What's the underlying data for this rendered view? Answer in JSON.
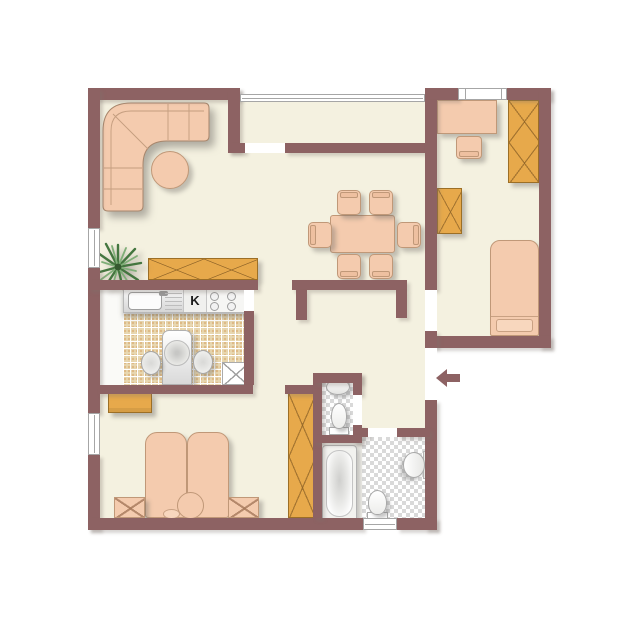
{
  "floorplan": {
    "title": "apartment-floor-plan",
    "kitchen_label": "K",
    "entrance": {
      "symbol": "arrow-left",
      "location": "right-wall-vestibule"
    },
    "colors": {
      "wall": "#8d6263",
      "floor": "#f4f1e0",
      "furniture_soft": "#f4cbae",
      "furniture_wood": "#e7a94b",
      "kitchen_tile": "#e8d8b2",
      "bath_tile_gray": "#d9d9d9",
      "background": "#ffffff"
    },
    "rooms": [
      {
        "name": "living-room",
        "furniture": [
          "corner-sofa",
          "round-table",
          "sideboard",
          "plant"
        ]
      },
      {
        "name": "balcony",
        "furniture": []
      },
      {
        "name": "dining-area",
        "furniture": [
          "dining-table",
          "six-chairs"
        ]
      },
      {
        "name": "kitchen",
        "label": "K",
        "furniture": [
          "sink-counter",
          "stove",
          "kitchen-table",
          "two-chairs",
          "corner-unit"
        ]
      },
      {
        "name": "bedroom-top-right",
        "furniture": [
          "desk",
          "desk-chair",
          "wardrobe",
          "cabinet",
          "single-bed"
        ]
      },
      {
        "name": "bedroom-bottom-left",
        "furniture": [
          "double-bed",
          "two-nightstands",
          "bench",
          "wardrobe"
        ]
      },
      {
        "name": "wc",
        "furniture": [
          "hand-basin",
          "toilet"
        ]
      },
      {
        "name": "bathroom",
        "furniture": [
          "bathtub",
          "wash-basin",
          "toilet"
        ]
      },
      {
        "name": "hallway",
        "furniture": []
      }
    ]
  }
}
